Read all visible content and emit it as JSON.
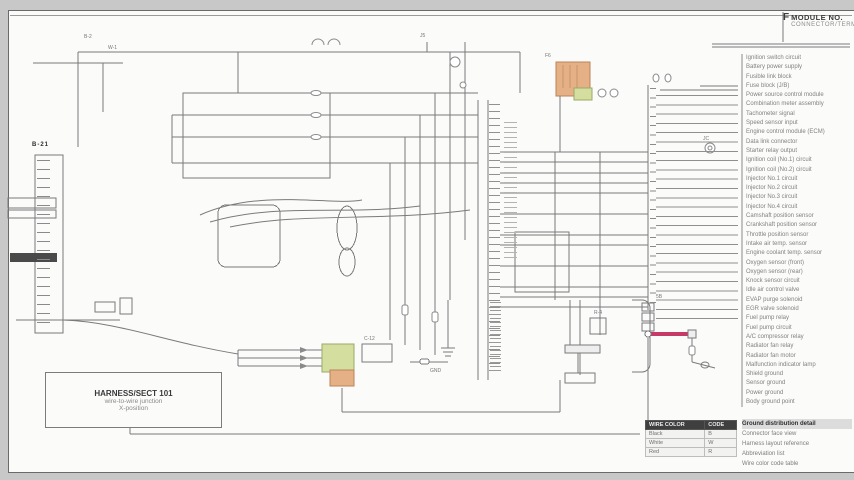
{
  "title_block": {
    "symbol": "F",
    "line1": "MODULE NO.",
    "line2": "CONNECTOR/TERM."
  },
  "note_box": {
    "line1": "HARNESS/SECT 101",
    "line2": "wire-to-wire junction",
    "line3": "X-position"
  },
  "legend": {
    "rows": [
      "Ignition switch circuit",
      "Battery power supply",
      "Fusible link block",
      "Fuse block (J/B)",
      "Power source control module",
      "Combination meter assembly",
      "Tachometer signal",
      "Speed sensor input",
      "Engine control module (ECM)",
      "Data link connector",
      "Starter relay output",
      "Ignition coil (No.1) circuit",
      "Ignition coil (No.2) circuit",
      "Injector No.1 circuit",
      "Injector No.2 circuit",
      "Injector No.3 circuit",
      "Injector No.4 circuit",
      "Camshaft position sensor",
      "Crankshaft position sensor",
      "Throttle position sensor",
      "Intake air temp. sensor",
      "Engine coolant temp. sensor",
      "Oxygen sensor (front)",
      "Oxygen sensor (rear)",
      "Knock sensor circuit",
      "Idle air control valve",
      "EVAP purge solenoid",
      "EGR valve solenoid",
      "Fuel pump relay",
      "Fuel pump circuit",
      "A/C compressor relay",
      "Radiator fan relay",
      "Radiator fan motor",
      "Malfunction indicator lamp",
      "Shield ground",
      "Sensor ground",
      "Power ground",
      "Body ground point"
    ]
  },
  "legend_footer": {
    "rows": [
      "Ground distribution detail",
      "Connector face view",
      "Harness layout reference",
      "Abbreviation list",
      "Wire color code table"
    ]
  },
  "color_table": {
    "headers": [
      "WIRE COLOR",
      "CODE"
    ],
    "rows": [
      [
        "Black",
        "B"
      ],
      [
        "White",
        "W"
      ],
      [
        "Red",
        "R"
      ]
    ]
  },
  "labels": [
    {
      "text": "B-2"
    },
    {
      "text": "W-1"
    },
    {
      "text": "J5"
    },
    {
      "text": "F6"
    },
    {
      "text": "C-12"
    },
    {
      "text": "R-4"
    },
    {
      "text": "5B"
    },
    {
      "text": "JC"
    },
    {
      "text": "B-21"
    },
    {
      "text": "GND"
    }
  ],
  "colors": {
    "wire": "#7a7a7a",
    "red_wire": "#c53a66",
    "connector_orange": "#e5b086",
    "connector_green": "#d4df9f"
  }
}
